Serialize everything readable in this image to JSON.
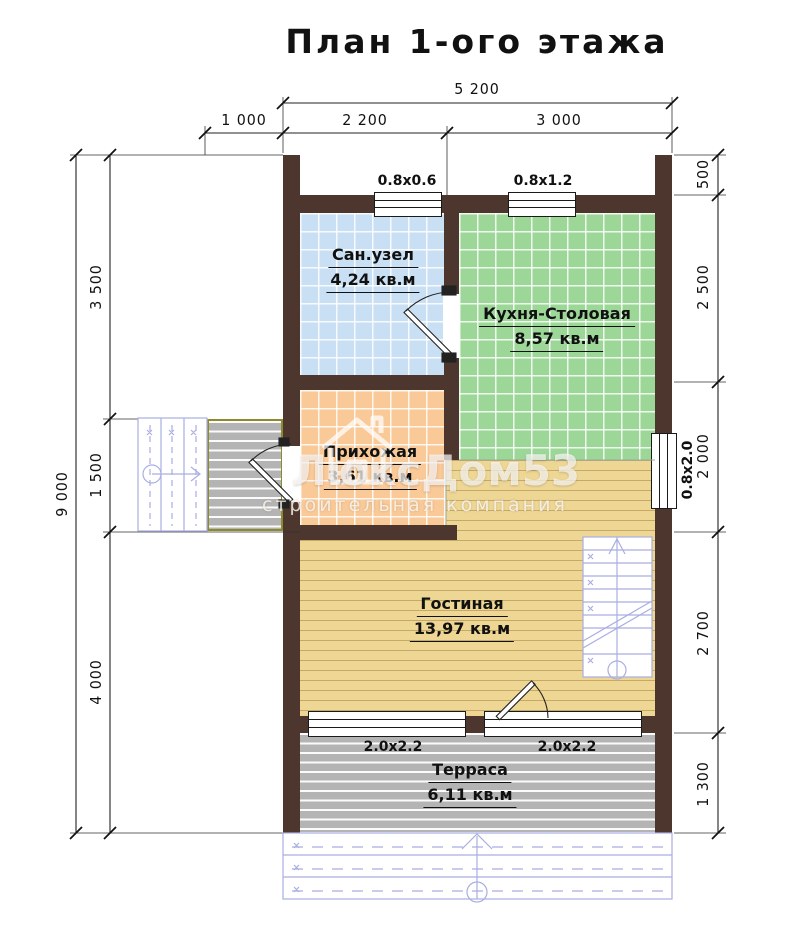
{
  "title": "План 1-ого этажа",
  "watermark": {
    "brand": "ЛюксДом53",
    "subtitle": "строительная компания"
  },
  "rooms": {
    "bathroom": {
      "name": "Сан.узел",
      "area": "4,24 кв.м"
    },
    "kitchen": {
      "name": "Кухня-Столовая",
      "area": "8,57 кв.м"
    },
    "hallway": {
      "name": "Прихожая",
      "area": "3,61 кв.м"
    },
    "living": {
      "name": "Гостиная",
      "area": "13,97 кв.м"
    },
    "terrace": {
      "name": "Терраса",
      "area": "6,11 кв.м"
    }
  },
  "windows": {
    "bathroom": "0.8x0.6",
    "kitchen": "0.8x1.2",
    "side": "0.8x2.0",
    "terrace_left": "2.0x2.2",
    "terrace_right": "2.0x2.2"
  },
  "dimensions": {
    "top": {
      "total": "5 200",
      "segments": [
        "1 000",
        "2 200",
        "3 000"
      ]
    },
    "left": {
      "total": "9 000",
      "segments": [
        "3 500",
        "1 500",
        "4 000"
      ]
    },
    "right": {
      "segments": [
        "500",
        "2 500",
        "2 000",
        "2 700",
        "1 300"
      ]
    }
  },
  "colors": {
    "wall": "#4d362e",
    "bathroom_floor": "#c9e0f4",
    "kitchen_floor": "#9cd798",
    "hallway_floor": "#f9c997",
    "wood_floor": "#eed694",
    "terrace_floor": "#b4b4b4",
    "stair_symbol": "#a9aee2",
    "line": "#1a1a1a"
  }
}
